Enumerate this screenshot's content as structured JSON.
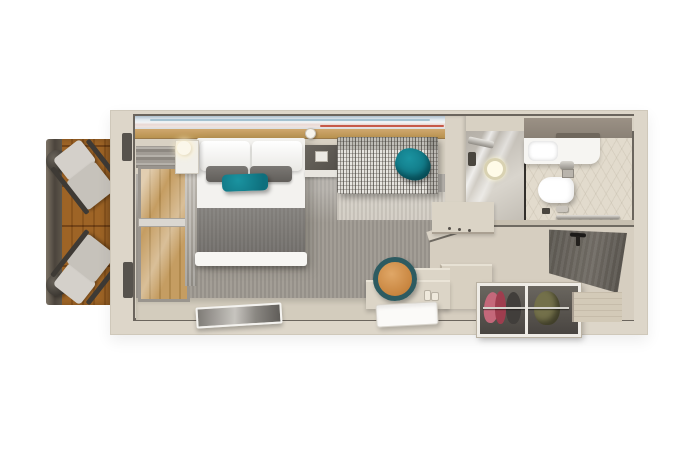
{
  "image": {
    "type": "3d-floor-plan-render",
    "subject": "cruise-ship balcony stateroom",
    "view": "top-down cutaway",
    "background_color": "#ffffff"
  },
  "palette": {
    "wall_beige": "#ddd6c9",
    "wall_edge_dark": "#6b655d",
    "carpet_gray": "#9a958d",
    "floor_beige": "#d6cec0",
    "deck_wood": "#c9a063",
    "teal_accent": "#12808e",
    "blanket_gray": "#7b7874",
    "door_dark": "#5a564f",
    "mirror_orange": "#c8853f",
    "mirror_ring_teal": "#2d5b61",
    "art_blue": "#aebfcc",
    "art_red": "#c24a39",
    "clothes_pink": "#c4687a",
    "clothes_red": "#9e3d4e",
    "clothes_olive": "#73704a"
  },
  "rooms": {
    "balcony": {
      "name": "balcony",
      "items": [
        "railing",
        "wood-deck",
        "deck-chair",
        "deck-chair",
        "round-side-table",
        "round-side-table"
      ]
    },
    "bedroom": {
      "name": "bedroom",
      "items": [
        "wall-art-band",
        "headboard-ledge",
        "double-bed",
        "white-pillows",
        "gray-pillows",
        "teal-accent-pillow",
        "gray-blanket",
        "white-foot-runner",
        "nightstand-with-lamp",
        "pendant-lamp",
        "dark-bedside-cabinet",
        "sofa",
        "teal-sofa-pillow",
        "sliding-glass-balcony-door",
        "curtain",
        "gray-carpet",
        "flat-tv-panel"
      ]
    },
    "bathroom": {
      "name": "bathroom",
      "items": [
        "glass-shower",
        "shower-head",
        "overhead-cabinet",
        "sink-counter",
        "sink-bowl",
        "faucet",
        "toilet",
        "flush-plate",
        "toilet-paper-holder",
        "floor-drain",
        "towel-rail",
        "tile-floor"
      ]
    },
    "entry": {
      "name": "entry-corridor",
      "items": [
        "entrance-door",
        "door-handle",
        "threshold",
        "wardrobe-two-sections",
        "hanging-clothes-pink",
        "hanging-clothes-red",
        "hanging-clothes-dark",
        "hanging-clothes-olive",
        "chrome-rail",
        "vanity-desk",
        "round-mirror",
        "perfume-bottles",
        "white-tray",
        "low-cabinet"
      ]
    }
  }
}
